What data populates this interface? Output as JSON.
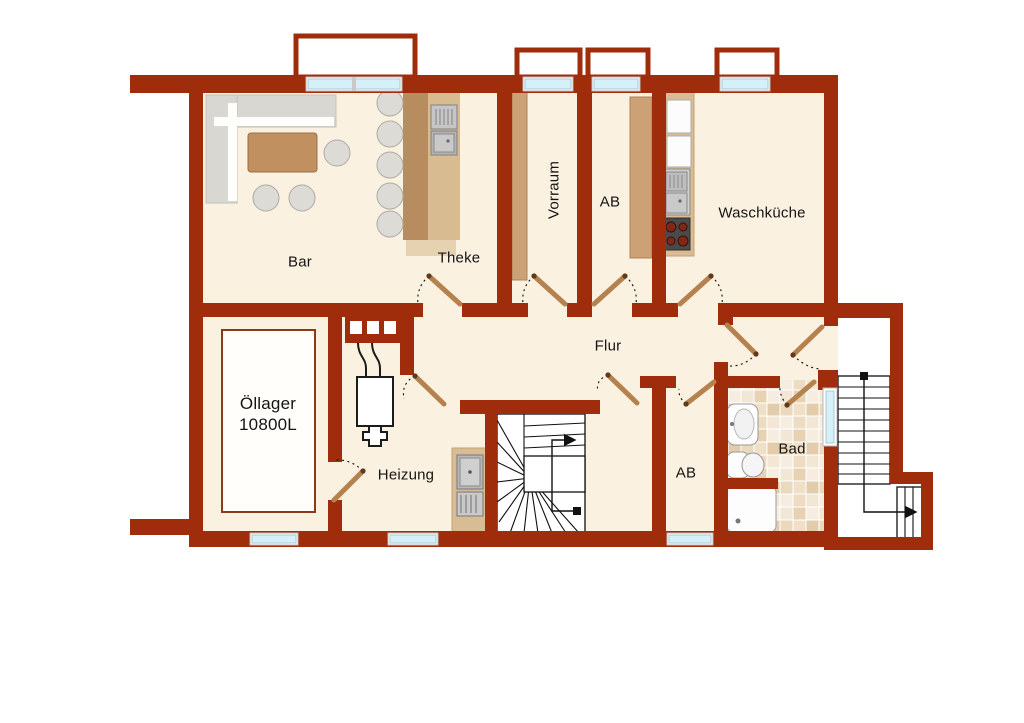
{
  "plan": {
    "type": "floor-plan",
    "floor": "basement",
    "rooms": {
      "bar": "Bar",
      "theke": "Theke",
      "vorraum": "Vorraum",
      "ab_top": "AB",
      "waschkueche": "Waschküche",
      "flur": "Flur",
      "oellager_line1": "Öllager",
      "oellager_line2": "10800L",
      "heizung": "Heizung",
      "ab_bottom": "AB",
      "bad": "Bad"
    },
    "colors": {
      "wall": "#9F2D0C",
      "floor": "#FBF1E1",
      "window_glass": "#D6F0F9",
      "wood": "#CBA175",
      "door_leaf": "#B5824E",
      "tile_dark": "#E5CFAF",
      "tile_light": "#F5EADB"
    }
  }
}
